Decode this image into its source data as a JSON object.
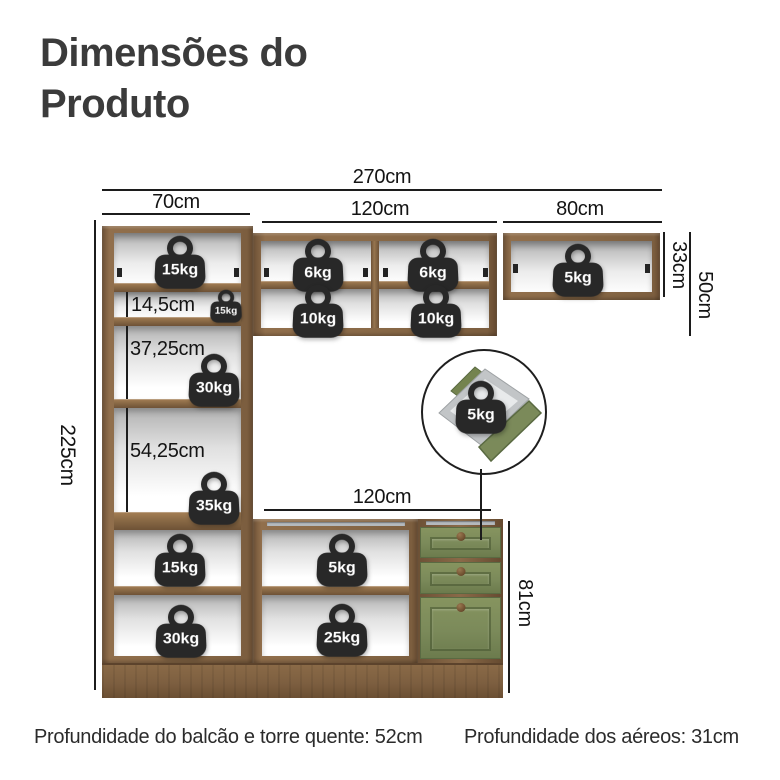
{
  "title": "Dimensões do Produto",
  "dims": {
    "total_width": "270cm",
    "tower_width": "70cm",
    "upper_mid_width": "120cm",
    "upper_right_width": "80cm",
    "upper_right_height": "33cm",
    "upper_mid_height": "50cm",
    "tower_height": "225cm",
    "shelf_small": "14,5cm",
    "shelf_mid": "37,25cm",
    "shelf_large": "54,25cm",
    "counter_width": "120cm",
    "counter_height": "81cm"
  },
  "weights": {
    "tower_top": "15kg",
    "tower_small_shelf": "15kg",
    "tower_shelf_mid": "30kg",
    "tower_shelf_large": "35kg",
    "tower_lower": "15kg",
    "tower_bottom": "30kg",
    "upper_mid_top_left": "6kg",
    "upper_mid_top_right": "6kg",
    "upper_mid_bottom_left": "10kg",
    "upper_mid_bottom_right": "10kg",
    "upper_right": "5kg",
    "counter_upper": "5kg",
    "counter_lower": "25kg",
    "drawer": "5kg"
  },
  "footer": {
    "left": "Profundidade do balcão e torre quente: 52cm",
    "right": "Profundidade dos aéreos: 31cm"
  },
  "colors": {
    "wood": "#8a6a48",
    "wood_dark": "#654a30",
    "green": "#7b8a5a",
    "green_dark": "#5a6a42",
    "badge": "#282828",
    "line": "#1c1c1c",
    "title_text": "#3b3b3b"
  }
}
